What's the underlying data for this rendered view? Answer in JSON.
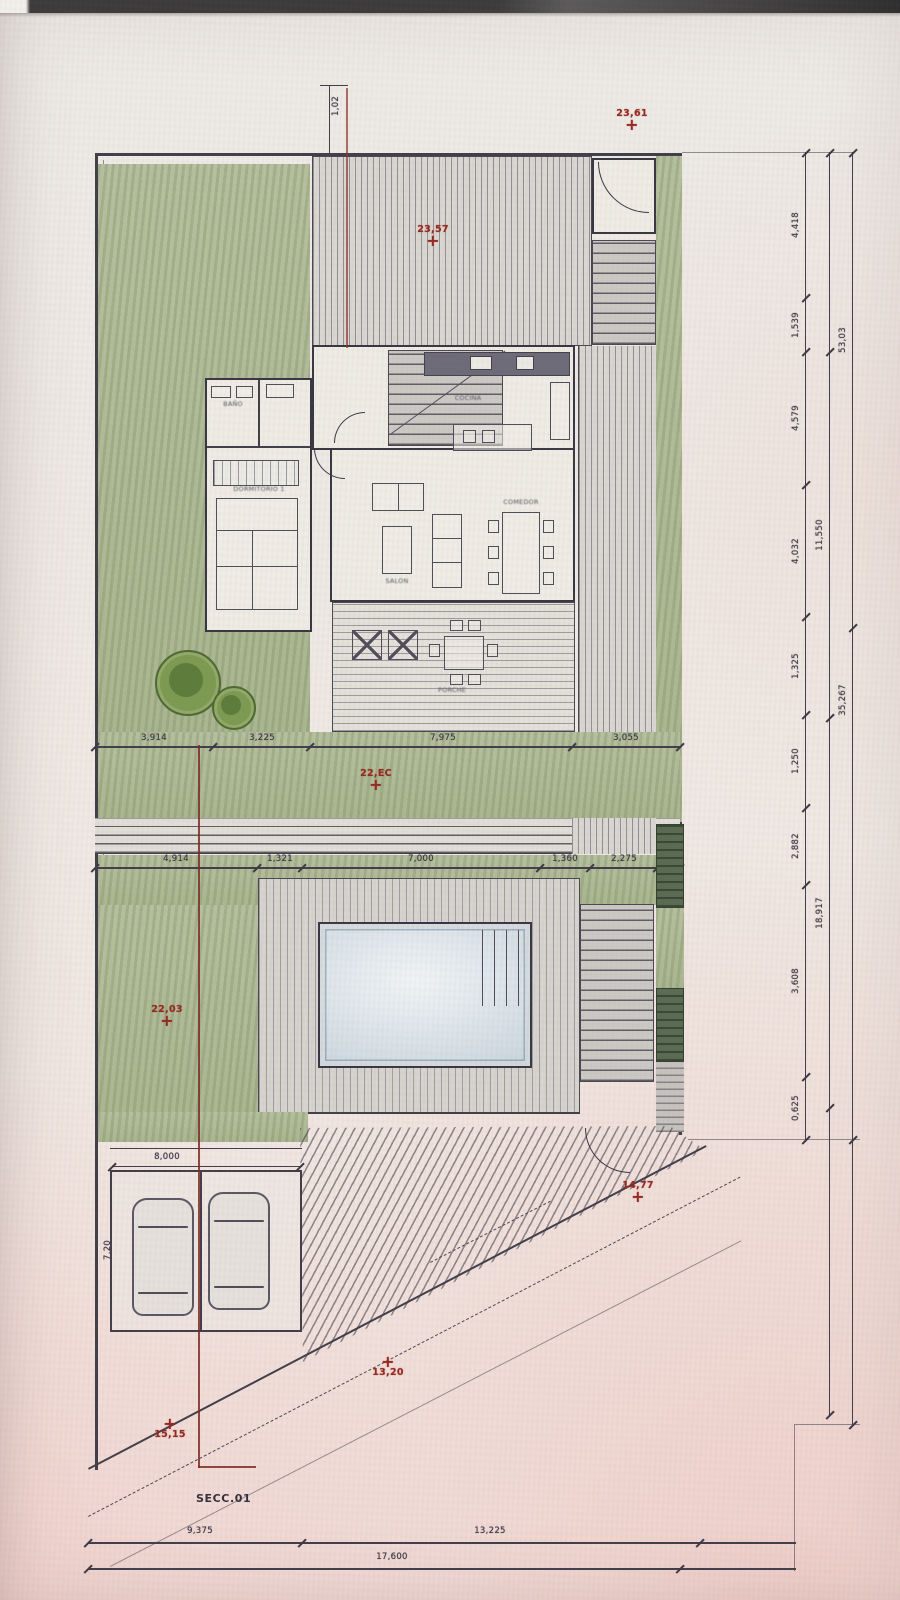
{
  "scan": {
    "section_label": "SECC.01"
  },
  "markers": [
    {
      "label": "23,61"
    },
    {
      "label": "23,57"
    },
    {
      "label": "22,EC"
    },
    {
      "label": "22,03"
    },
    {
      "label": "14,77"
    },
    {
      "label": "13,20"
    },
    {
      "label": "15,15"
    }
  ],
  "dims": {
    "row1": [
      "3,914",
      "3,225",
      "7,975",
      "3,055"
    ],
    "row2": [
      "4,914",
      "1,321",
      "7,000",
      "1,360",
      "2,275"
    ],
    "bottom_left": "9,375",
    "bottom_mid": "13,225",
    "bottom_total": "17,600",
    "garage_width": "8,000",
    "garage_side": "7,20",
    "top_small": "1,02"
  },
  "right_chain": {
    "inner": [
      "4,418",
      "1,539",
      "4,579",
      "4,032",
      "1,325",
      "1,250",
      "2,882",
      "3,608",
      "0,625"
    ],
    "middle": [
      "11,550",
      "18,917"
    ],
    "outer": [
      "53,03",
      "35,267"
    ]
  },
  "rooms": {
    "bedroom": "DORMITORIO 1",
    "bath": "BAÑO",
    "kitchen": "COCINA",
    "dining": "COMEDOR",
    "living": "SALON",
    "porch": "PORCHE"
  }
}
